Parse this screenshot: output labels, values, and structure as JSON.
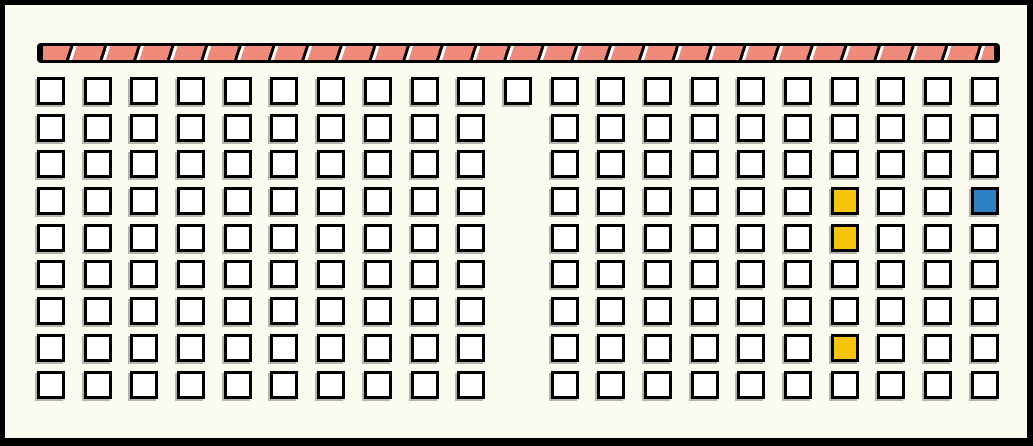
{
  "frame": {
    "background": "#fbfbef",
    "border_color": "#000000"
  },
  "stripe_bar": {
    "fill": "#f08a7a",
    "stripe_color": "#000000",
    "gap_color": "#ffffff",
    "border_color": "#000000"
  },
  "legend": {
    "white": "#ffffff",
    "yellow": "#f6c50b",
    "blue": "#2f80c3"
  },
  "grid": {
    "codes": {
      "w": "white",
      "y": "yellow",
      "b": "blue",
      ".": "empty"
    },
    "rows": [
      "wwwwwwwwwwwwwwwwwwwww",
      "wwwwwwwwww.wwwwwwwwww",
      "wwwwwwwwww.wwwwwwwwww",
      "wwwwwwwwww.wwwwwwywwb",
      "wwwwwwwwww.wwwwwwywww",
      "wwwwwwwwww.wwwwwwwwww",
      "wwwwwwwwww.wwwwwwwwww",
      "wwwwwwwwww.wwwwwwywww",
      "wwwwwwwwww.wwwwwwwwww"
    ]
  }
}
